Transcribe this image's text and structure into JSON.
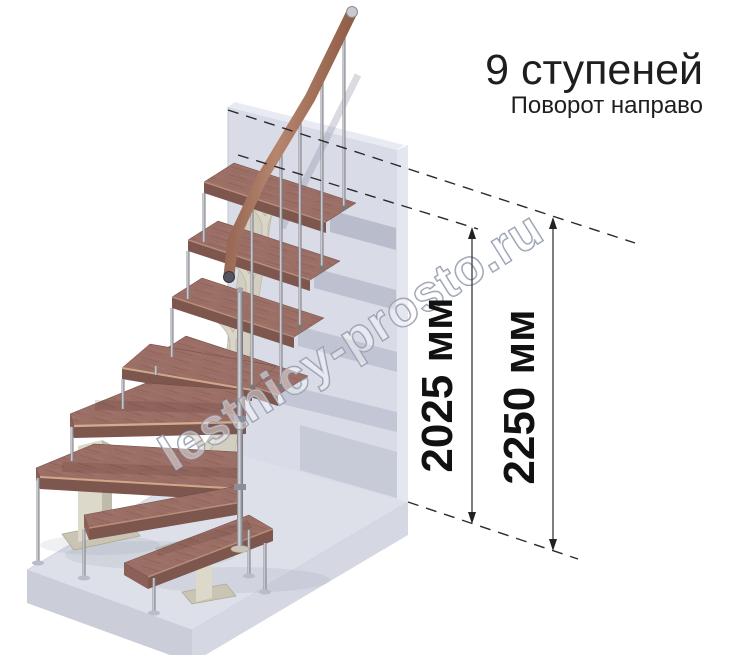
{
  "header": {
    "title": "9 ступеней",
    "subtitle": "Поворот направо"
  },
  "dimensions": [
    {
      "id": "stair-height",
      "label": "2025 мм"
    },
    {
      "id": "floor-height",
      "label": "2250 мм"
    }
  ],
  "watermark": {
    "text": "lestnicy-prosto.ru"
  },
  "scene": {
    "steps_total": 9,
    "colors": {
      "background": "#ffffff",
      "wall_front": "#d9dbe7",
      "wall_side": "#e4e6f0",
      "floor_top": "#dde0e9",
      "floor_front": "#ccd0db",
      "tread_wood": "#9c6f66",
      "tread_edge": "#7d564e",
      "nosing": "#d8b191",
      "handrail": "#96604a",
      "metal": "#95959d",
      "frame_cream": "#d9d5c7",
      "annotation": "#1f1f1f"
    }
  }
}
